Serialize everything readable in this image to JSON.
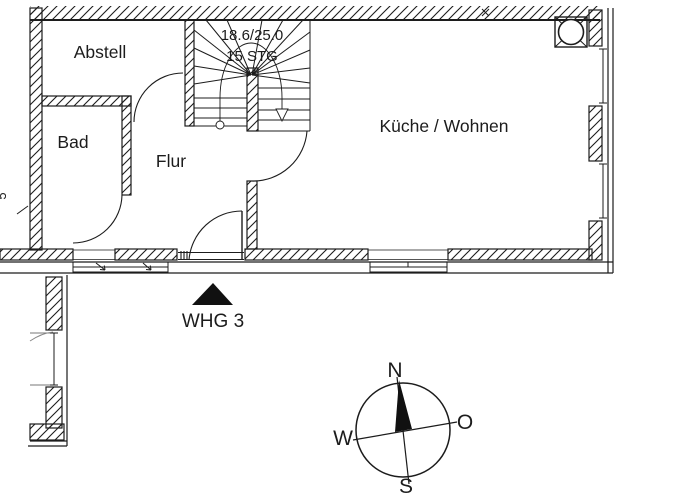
{
  "drawing": {
    "rooms": {
      "abstell": "Abstell",
      "bad": "Bad",
      "flur": "Flur",
      "kueche_wohnen": "Küche / Wohnen"
    },
    "staircase": {
      "dimension_label": "18.6/25.0",
      "steps_label": "15 STG"
    },
    "unit_marker": {
      "label": "WHG 3"
    },
    "compass": {
      "n": "N",
      "o": "O",
      "s": "S",
      "w": "W"
    },
    "edge_dimension_fragment": "5"
  },
  "colors": {
    "ink": "#1c1c1c",
    "background": "#ffffff"
  }
}
